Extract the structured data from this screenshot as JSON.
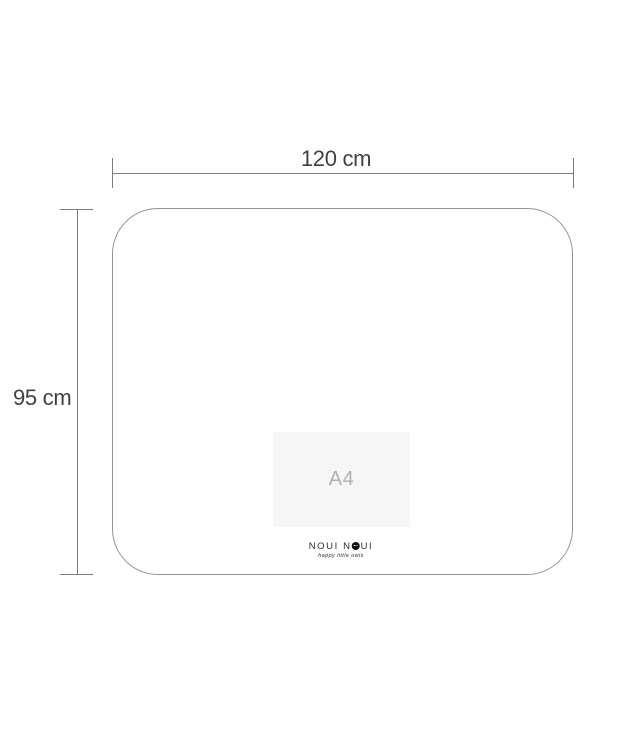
{
  "image": {
    "type": "product-dimension-diagram",
    "background": "#ffffff"
  },
  "dimensions": {
    "width": {
      "label": "120 cm"
    },
    "height": {
      "label": "95 cm"
    }
  },
  "placemat": {
    "a4_reference_label": "A4"
  },
  "brand": {
    "name": "NOUI NOUI",
    "name_before_owl": "NOUI N",
    "name_after_owl": "UI",
    "tagline": "happy little owls"
  },
  "colors": {
    "dimension_line": "#7d7d7d",
    "dimension_text": "#414141",
    "outline": "#929292",
    "a4_fill": "#f6f6f6",
    "a4_text": "#b0b0b0",
    "logo_text": "#2f2f2f",
    "owl": "#111111",
    "page_bg": "#ffffff"
  }
}
